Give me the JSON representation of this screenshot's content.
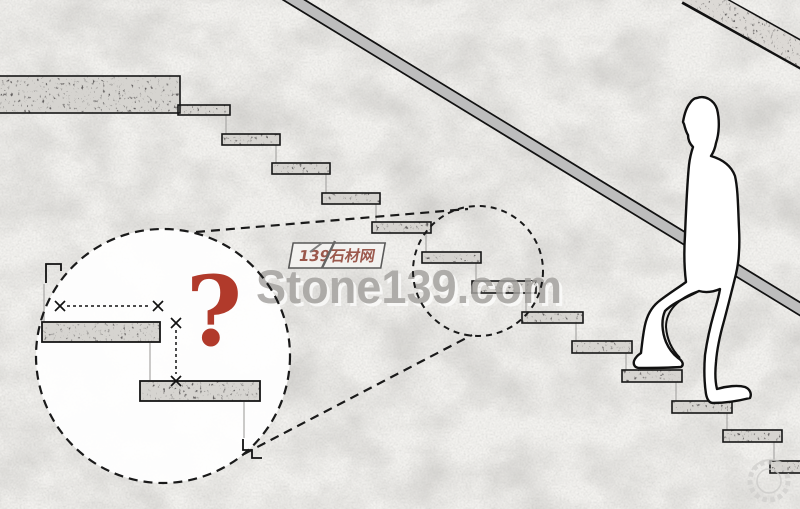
{
  "watermark": {
    "brand": "Stone139.com",
    "brand_color": "#a3a19e",
    "brand_highlight": "#fcfcfb",
    "site_label": "139石材网",
    "site_label_color": "#8b3a2c",
    "site_label_box_color": "#f6f5f3"
  },
  "detail_callout": {
    "question_mark": "?",
    "question_color": "#b13a2b"
  },
  "colors": {
    "background": "#f3f2ef",
    "step_fill": "#d6d4d0",
    "step_border": "#161616",
    "railing_fill": "#bdbdbd",
    "outline": "#111111"
  }
}
